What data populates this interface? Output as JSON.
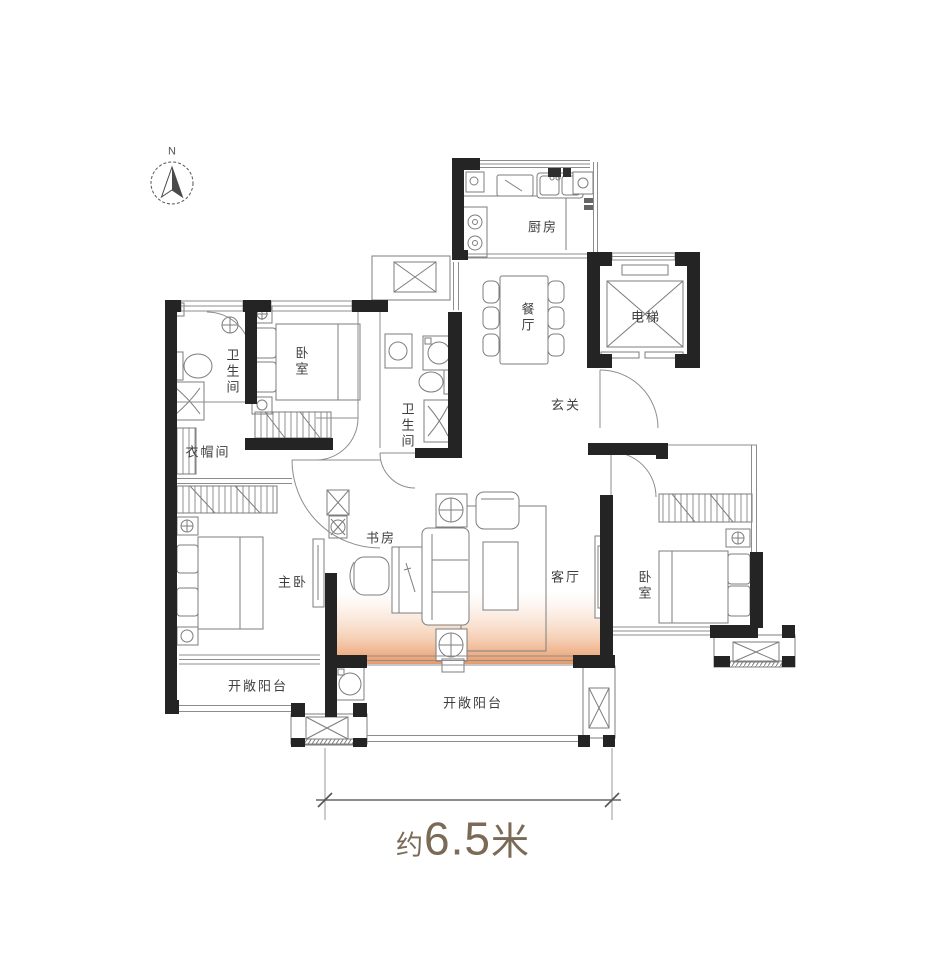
{
  "compass": {
    "label": "N"
  },
  "rooms": {
    "kitchen": {
      "label": "厨房"
    },
    "dining": {
      "label": "餐厅"
    },
    "elevator": {
      "label": "电梯"
    },
    "foyer": {
      "label": "玄关"
    },
    "bathroom_1": {
      "label": "卫生间"
    },
    "bedroom_1": {
      "label": "卧室"
    },
    "cloakroom": {
      "label": "衣帽间"
    },
    "bathroom_2": {
      "label": "卫生间"
    },
    "master_bedroom": {
      "label": "主卧"
    },
    "study": {
      "label": "书房"
    },
    "living_room": {
      "label": "客厅"
    },
    "bedroom_2": {
      "label": "卧室"
    },
    "balcony_left": {
      "label": "开敞阳台"
    },
    "balcony_bottom": {
      "label": "开敞阳台"
    }
  },
  "dimension": {
    "prefix": "约",
    "value": "6.5",
    "unit": "米"
  },
  "colors": {
    "wall": "#242424",
    "thin_line": "#8d8d8d",
    "furniture": "#7d7d7d",
    "highlight": "#e8945f",
    "dimension_text": "#7b6a56",
    "label_text": "#3f3f3f",
    "background": "#ffffff"
  }
}
